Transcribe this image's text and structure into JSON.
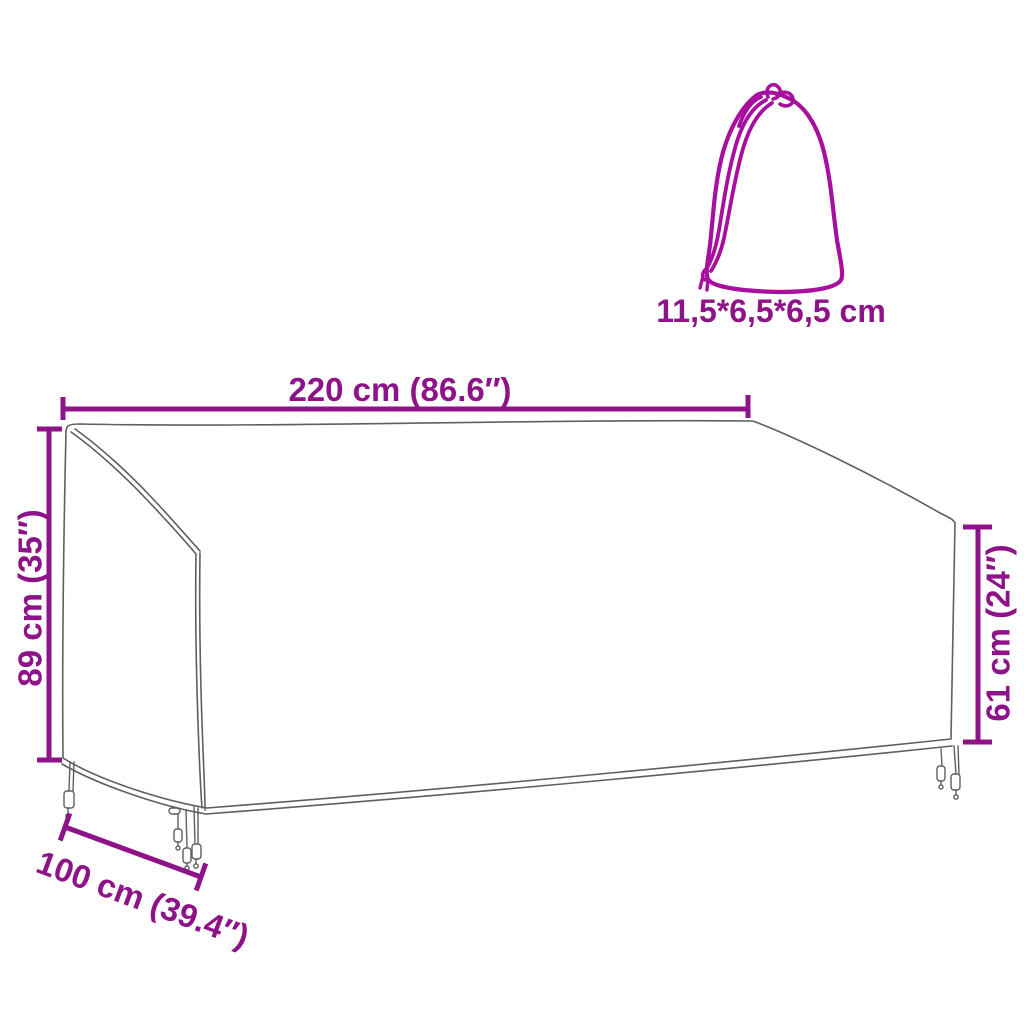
{
  "diagram": {
    "kind": "product-dimension-diagram",
    "subject": "outdoor bench cover with drawstring storage bag",
    "colors": {
      "accent": "#8E1389",
      "bag": "#A80F9E",
      "outline": "#5f5f5f"
    },
    "labels": {
      "width": "220 cm (86.6″)",
      "back_height": "89 cm (35″)",
      "front_height": "61 cm (24″)",
      "depth": "100 cm (39.4″)",
      "bag_size": "11,5*6,5*6,5 cm"
    }
  }
}
